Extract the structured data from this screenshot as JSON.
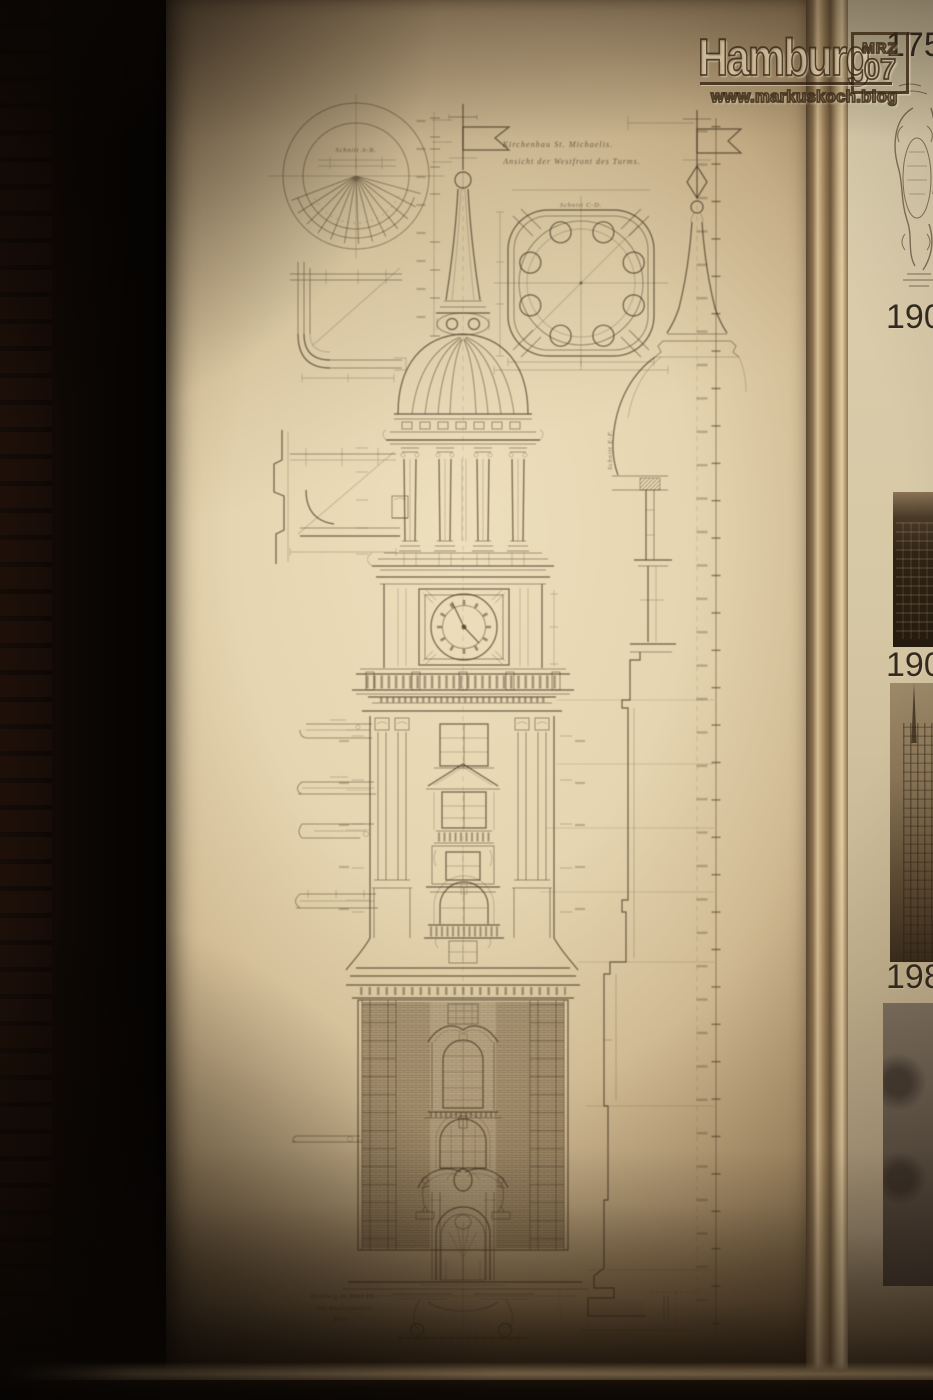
{
  "watermark": {
    "brand": "Hamburg",
    "stamp_line1": "MRZ",
    "stamp_line2": "07",
    "url": "www.markuskoch.blog"
  },
  "drawing": {
    "title_line1": "Kirchenbau St. Michaelis.",
    "title_line2": "Ansicht der Westfront des Turms.",
    "label_plan_top": "Schnitt A-B.",
    "label_plan_lantern": "Schnitt C-D.",
    "label_profile": "Schnitt E-F.",
    "inscription_line1": "Hamburg im März 19..",
    "inscription_line2": "Die Baudeputation",
    "inscription_line3": "Blatt .."
  },
  "timeline": {
    "entries": [
      {
        "year": "175",
        "media": "engraving-baroque-cartouche"
      },
      {
        "year": "190",
        "media": "photo-church-facade"
      },
      {
        "year": "190",
        "media": "photo-tower-under-construction"
      },
      {
        "year": "198",
        "media": "photo-tower-dark"
      }
    ]
  },
  "colors": {
    "panel_cream": "#e9dab8",
    "drawing_line": "#453522",
    "wall_black": "#0a0603",
    "frame_metal": "#cfb388",
    "timeline_paper": "#d9cca9",
    "floor": "#120c07"
  }
}
